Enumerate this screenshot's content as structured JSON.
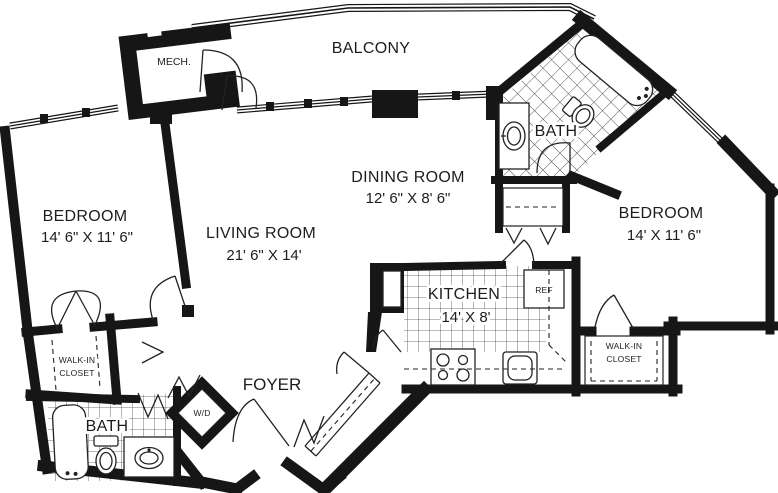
{
  "floor_plan": {
    "colors": {
      "wall": "#161616",
      "background": "#ffffff",
      "line": "#222222"
    },
    "rooms": {
      "balcony": {
        "label": "BALCONY"
      },
      "mech": {
        "label": "MECH."
      },
      "bedroom1": {
        "label": "BEDROOM",
        "dims": "14' 6\" X 11' 6\""
      },
      "living": {
        "label": "LIVING ROOM",
        "dims": "21' 6\" X 14'"
      },
      "dining": {
        "label": "DINING ROOM",
        "dims": "12' 6\" X 8' 6\""
      },
      "bath_top": {
        "label": "BATH"
      },
      "bedroom2": {
        "label": "BEDROOM",
        "dims": "14' X 11' 6\""
      },
      "kitchen": {
        "label": "KITCHEN",
        "dims": "14' X 8'"
      },
      "foyer": {
        "label": "FOYER"
      },
      "bath_bottom": {
        "label": "BATH"
      },
      "walk_in_closet_left": {
        "line1": "WALK-IN",
        "line2": "CLOSET"
      },
      "walk_in_closet_right": {
        "line1": "WALK-IN",
        "line2": "CLOSET"
      }
    },
    "fixtures": {
      "refrigerator": {
        "label": "REF"
      },
      "washer_dryer": {
        "label": "W/D"
      }
    }
  }
}
